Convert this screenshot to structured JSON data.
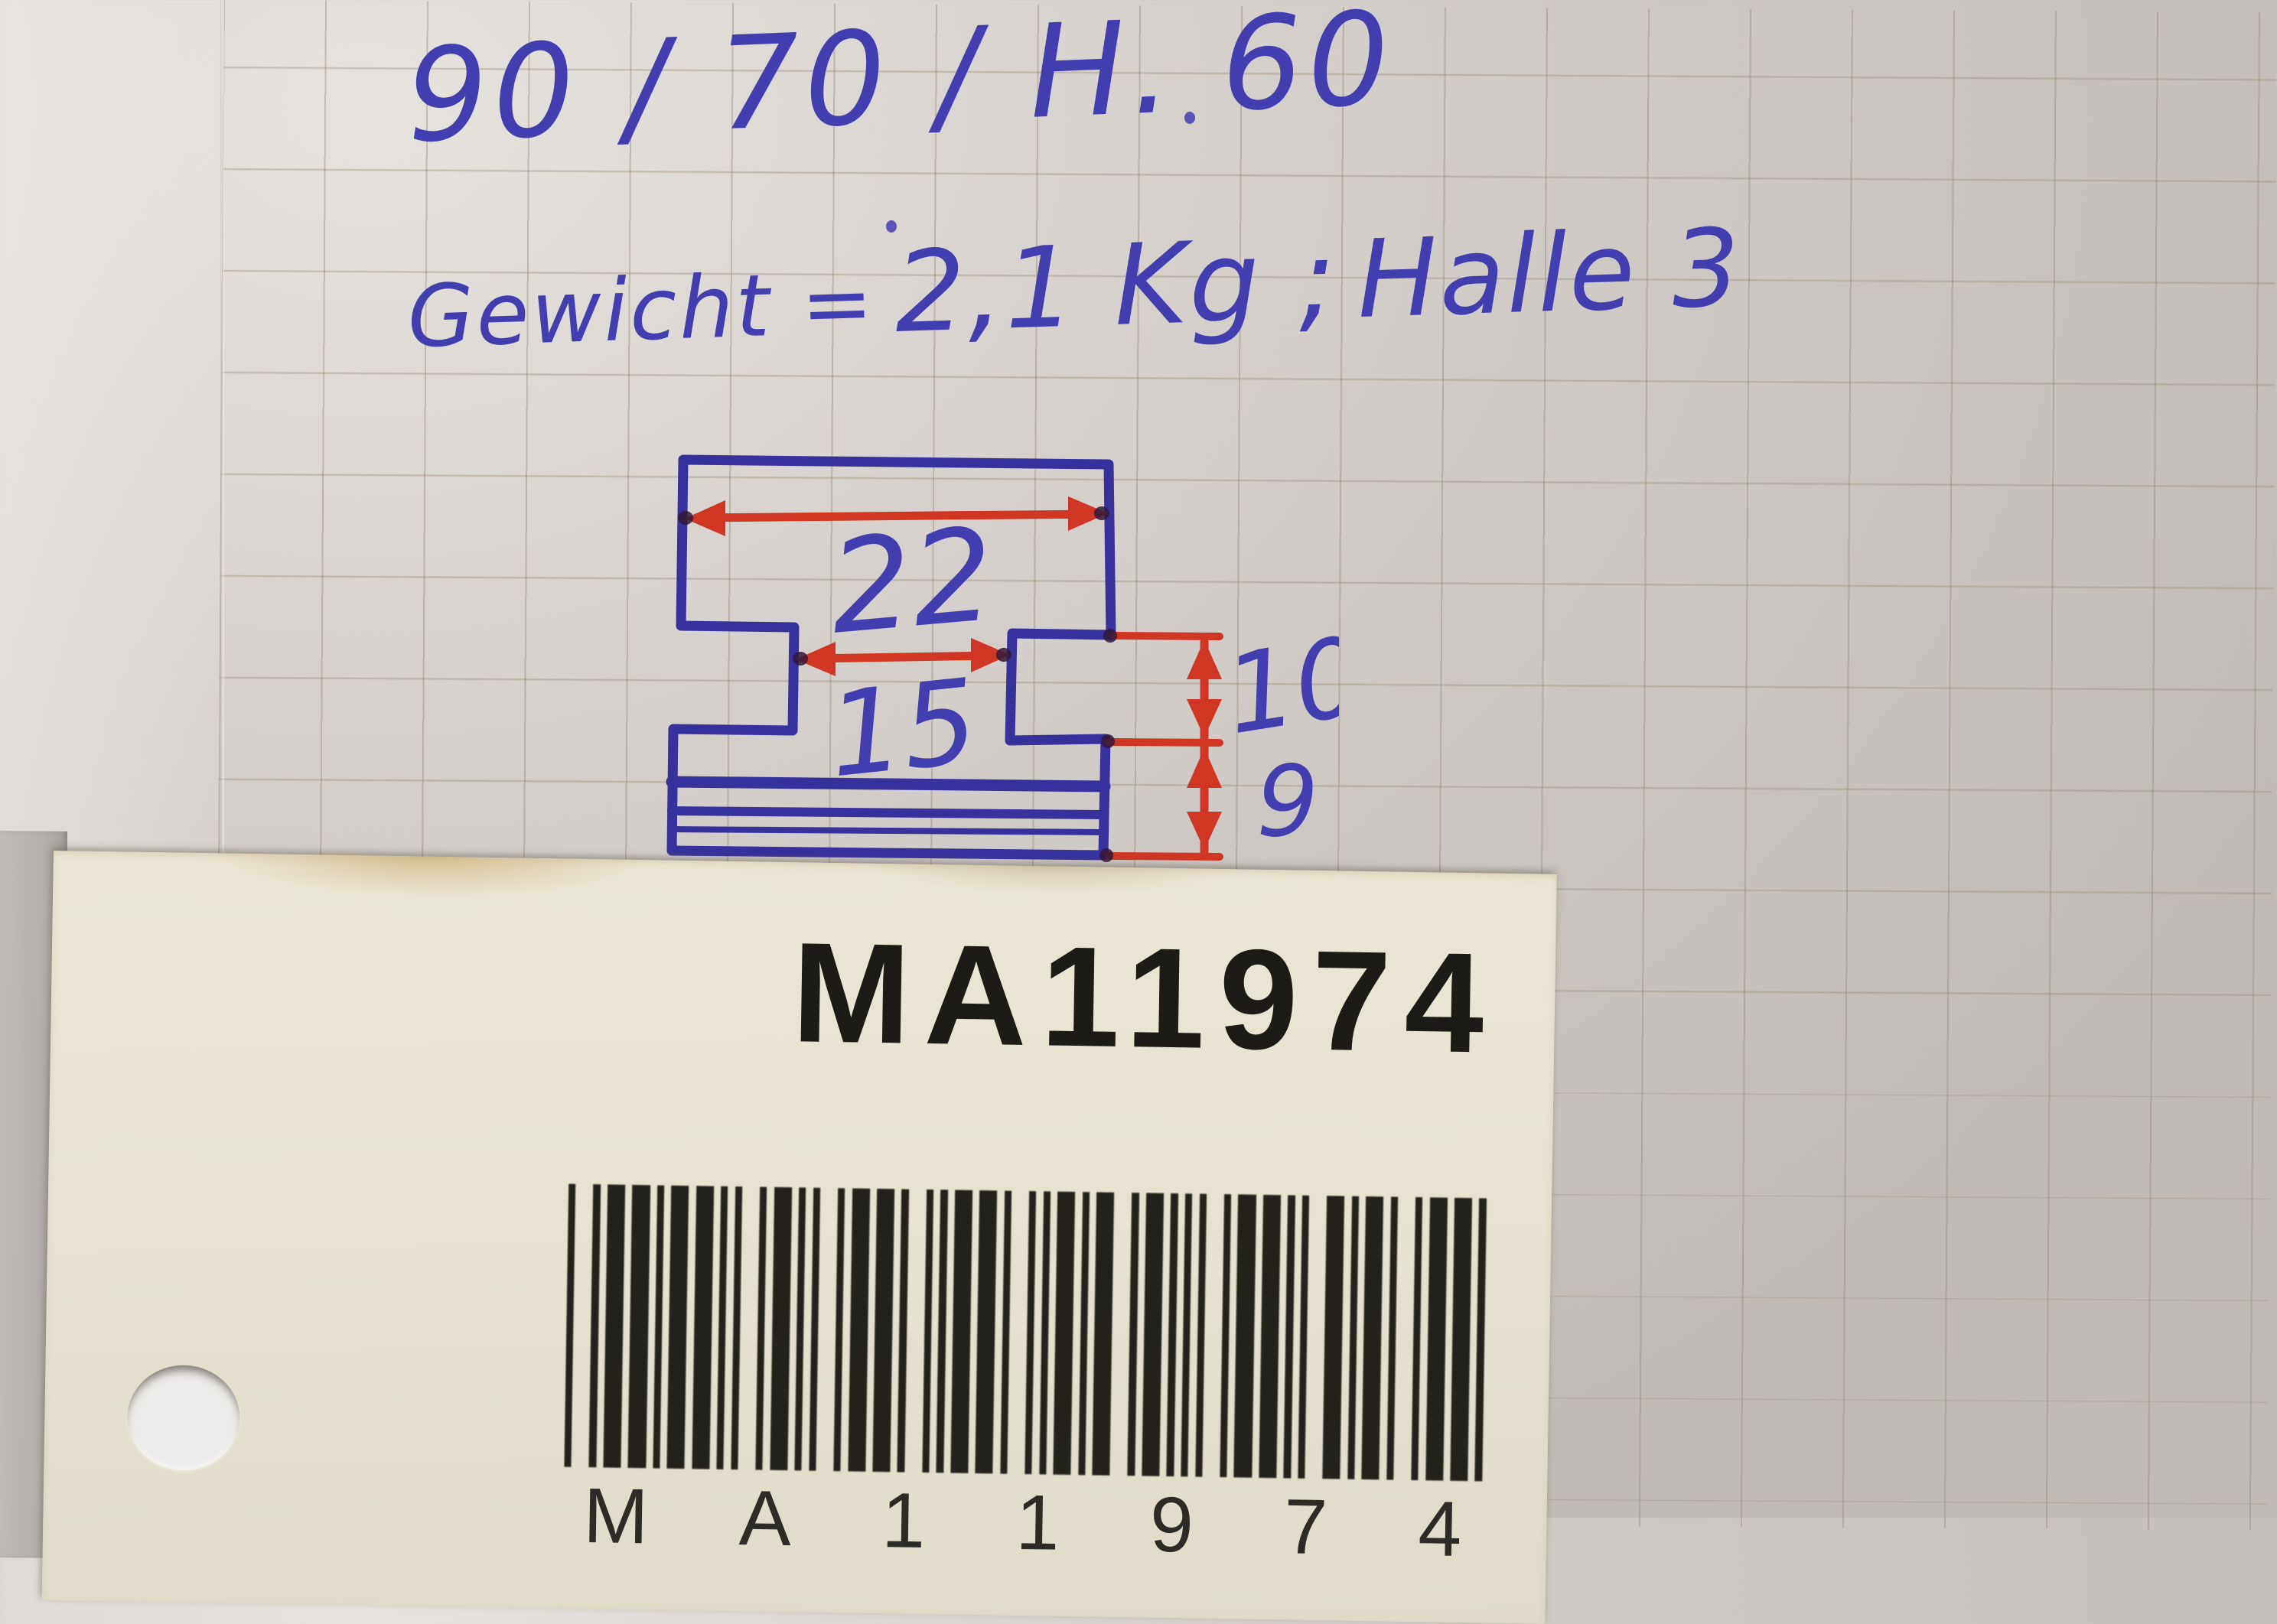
{
  "note": {
    "line1": "90 / 70 / H. 60",
    "line2_label": "Gewicht =",
    "line2_value": "2,1 Kg ;",
    "line2_place": "Halle 3"
  },
  "sketch": {
    "top_width": "22",
    "neck_width": "15",
    "upper_height": "10",
    "lower_height": "9"
  },
  "tag": {
    "code": "MA11974"
  },
  "colors": {
    "ink_blue": "#433eb0",
    "sketch_blue": "#37319d",
    "ink_red": "#cf3623",
    "paper": "#d3cec9",
    "tag": "#e8e3d1",
    "barcode": "#23211c"
  }
}
